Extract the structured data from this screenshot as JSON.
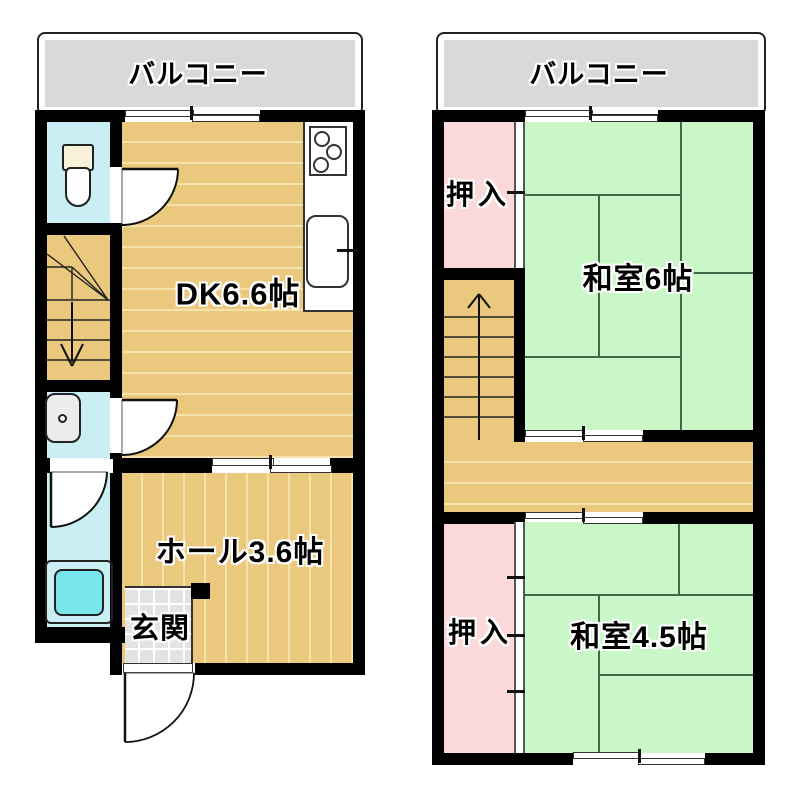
{
  "plan": {
    "floor1": {
      "balcony_label": "バルコニー",
      "dk_label": "DK6.6帖",
      "hall_label": "ホール3.6帖",
      "entrance_label": "玄関"
    },
    "floor2": {
      "balcony_label": "バルコニー",
      "closet_north_label": "押入",
      "tatami6_label": "和室6帖",
      "closet_south_label": "押入",
      "tatami45_label": "和室4.5帖"
    }
  },
  "colors": {
    "wall": "#000000",
    "wood_floor": "#eac87d",
    "wood_stripe": "#f5e3ab",
    "water_room": "#c9eff5",
    "tatami_green": "#c9f7c8",
    "tatami_line": "#46684a",
    "closet_pink": "#fbd9da",
    "balcony_gray": "#d9d9d9",
    "entrance_tile": "#e3e3e3",
    "bathtub": "#79e6ee"
  }
}
